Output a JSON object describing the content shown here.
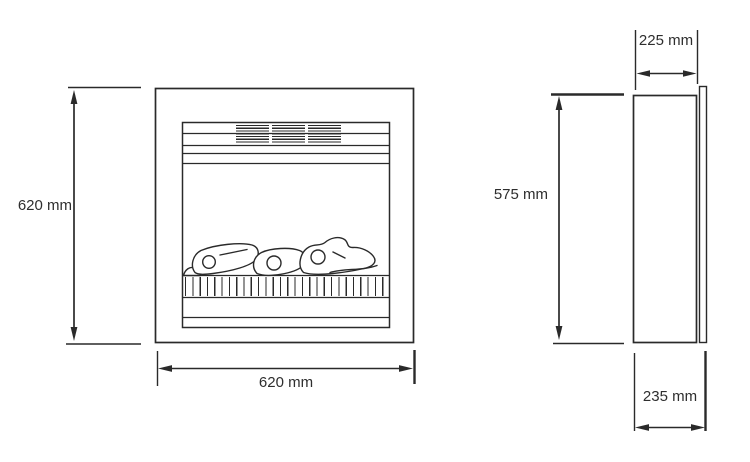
{
  "diagram": {
    "subject": "electric-fire-insert-dimension-drawing"
  },
  "views": {
    "front": {
      "height_label": "620 mm",
      "width_label": "620 mm"
    },
    "side": {
      "height_label": "575 mm",
      "depth_top_label": "225 mm",
      "depth_bottom_label": "235 mm"
    }
  },
  "colors": {
    "line": "#2a2a2a",
    "text": "#2e2e2e",
    "background": "#ffffff"
  }
}
